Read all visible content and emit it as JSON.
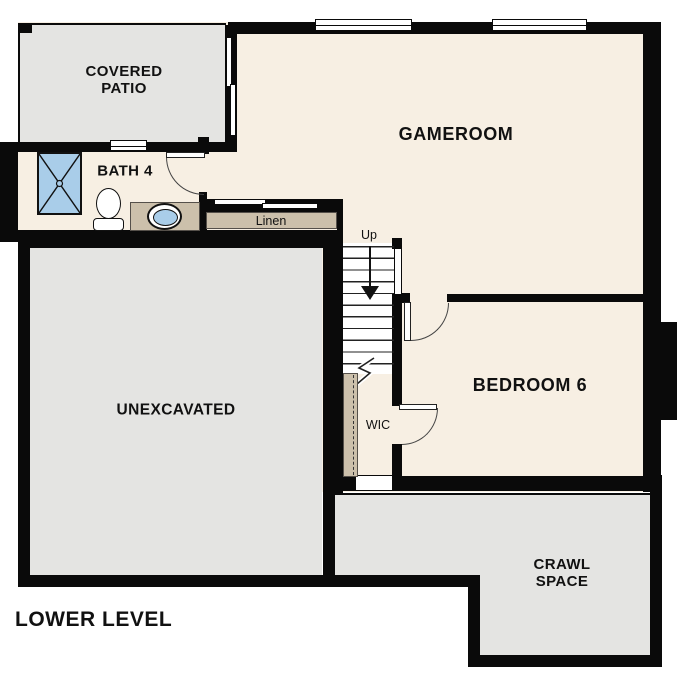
{
  "plan_title": "LOWER LEVEL",
  "colors": {
    "floor_cream": "#f7efe3",
    "concrete_gray": "#e4e4e2",
    "counter_tan": "#ccc0ab",
    "water_blue": "#a9cde9",
    "wall_black": "#0a0a0a"
  },
  "rooms": {
    "covered_patio": {
      "line1": "COVERED",
      "line2": "PATIO"
    },
    "gameroom": {
      "label": "GAMEROOM"
    },
    "bath4": {
      "label": "BATH 4"
    },
    "linen": {
      "label": "Linen"
    },
    "stairs": {
      "label": "Up"
    },
    "unexcavated": {
      "label": "UNEXCAVATED"
    },
    "bedroom6": {
      "label": "BEDROOM 6"
    },
    "wic": {
      "label": "WIC"
    },
    "crawl_space": {
      "line1": "CRAWL",
      "line2": "SPACE"
    }
  },
  "fixtures": {
    "shower": "shower-stall-icon",
    "toilet": "toilet-icon",
    "sink": "vanity-sink-icon",
    "closet_rod": "hanging-rod-dashed",
    "stairs_direction_arrow": "down-arrow"
  }
}
